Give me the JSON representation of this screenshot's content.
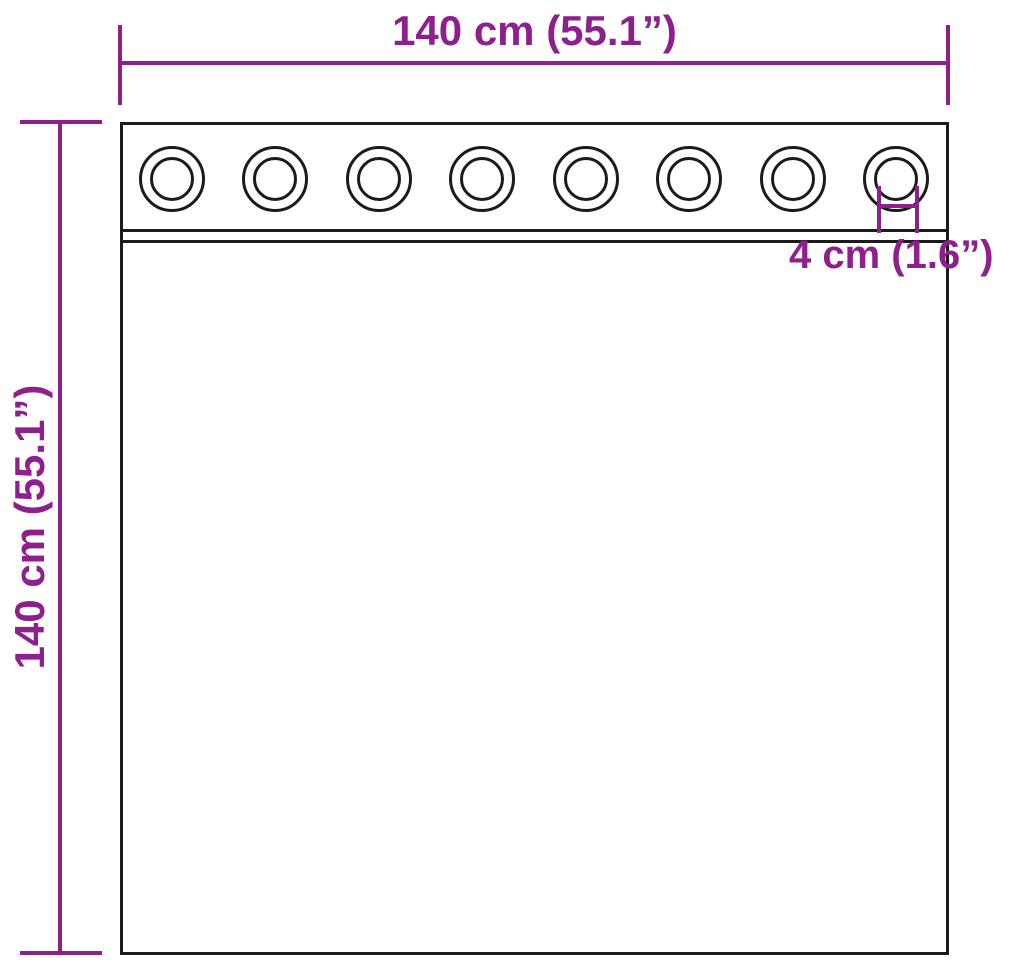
{
  "diagram": {
    "type": "product-dimension-drawing",
    "subject": "curtain-with-grommets",
    "colors": {
      "dimension": "#8d208d",
      "outline": "#1b1b1b",
      "background": "#ffffff"
    },
    "labels": {
      "width": "140 cm (55.1”)",
      "height": "140 cm (55.1”)",
      "grommet_diameter": "4 cm (1.6”)"
    },
    "grommets": {
      "count": 8
    }
  }
}
